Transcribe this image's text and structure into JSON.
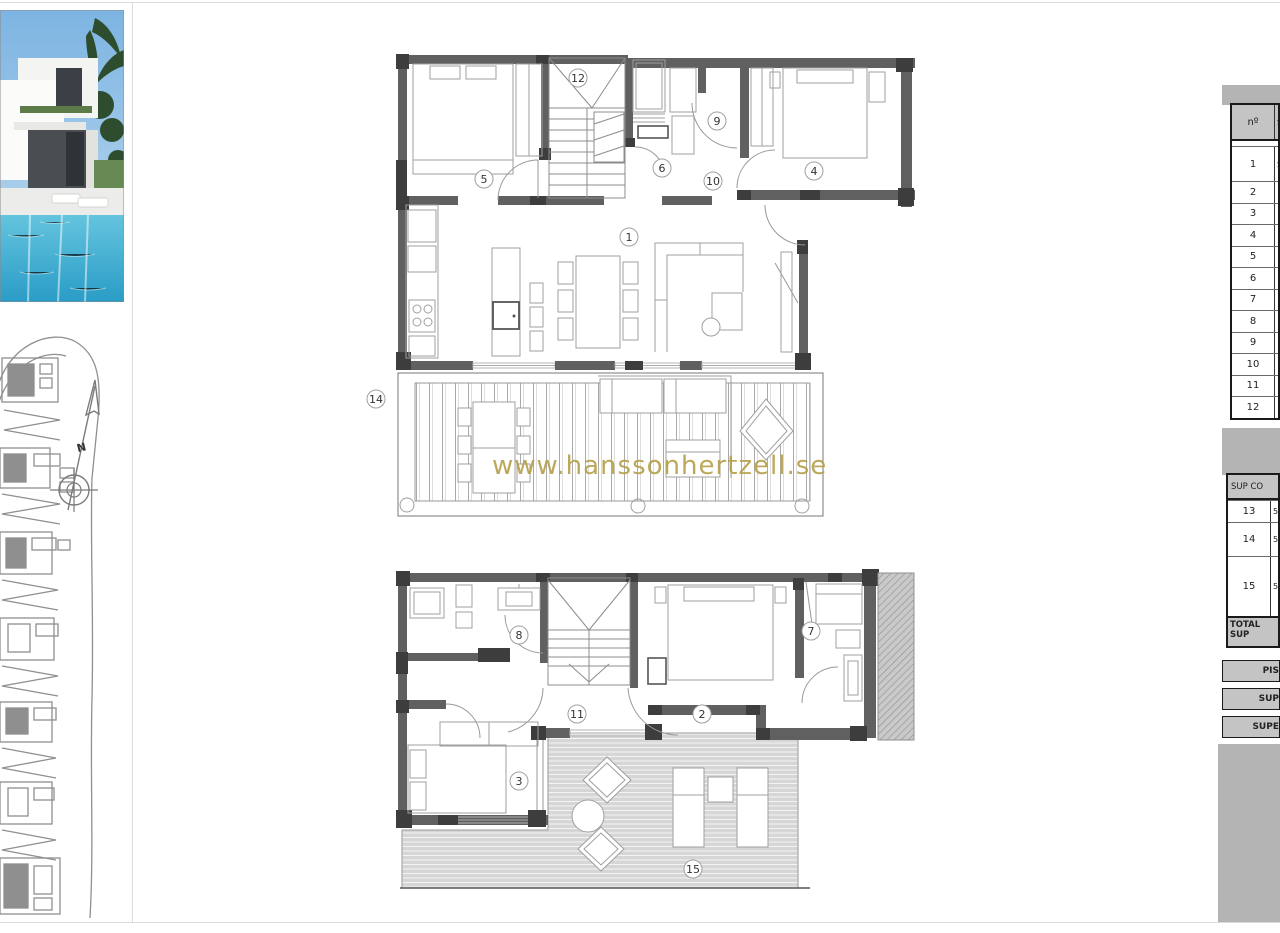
{
  "watermark": {
    "text": "www.hanssonhertzell.se",
    "color": "#b59f4a"
  },
  "compass": {
    "letter": "N"
  },
  "rooms": {
    "n1": "1",
    "n2": "2",
    "n3": "3",
    "n4": "4",
    "n5": "5",
    "n6": "6",
    "n7": "7",
    "n8": "8",
    "n9": "9",
    "n10": "10",
    "n11": "11",
    "n12": "12",
    "n14": "14",
    "n15": "15",
    "n15b": "15"
  },
  "table": {
    "header_no": "nº",
    "header_col2": "S",
    "rows": [
      {
        "n": "1",
        "frag": "S"
      },
      {
        "n": "2",
        "frag": ""
      },
      {
        "n": "3",
        "frag": ""
      },
      {
        "n": "4",
        "frag": ""
      },
      {
        "n": "5",
        "frag": ""
      },
      {
        "n": "6",
        "frag": ""
      },
      {
        "n": "7",
        "frag": ""
      },
      {
        "n": "8",
        "frag": ""
      },
      {
        "n": "9",
        "frag": ""
      },
      {
        "n": "10",
        "frag": ""
      },
      {
        "n": "11",
        "frag": ""
      },
      {
        "n": "12",
        "frag": ""
      }
    ],
    "section2": {
      "header": "SUP CO",
      "rows": [
        {
          "n": "13",
          "frag": "5"
        },
        {
          "n": "14",
          "frag": "5"
        },
        {
          "n": "15",
          "frag": "5"
        }
      ],
      "total_label": "TOTAL SUP"
    },
    "bars": [
      {
        "label": "PIS"
      },
      {
        "label": "SUP"
      },
      {
        "label": "SUPE"
      }
    ]
  }
}
